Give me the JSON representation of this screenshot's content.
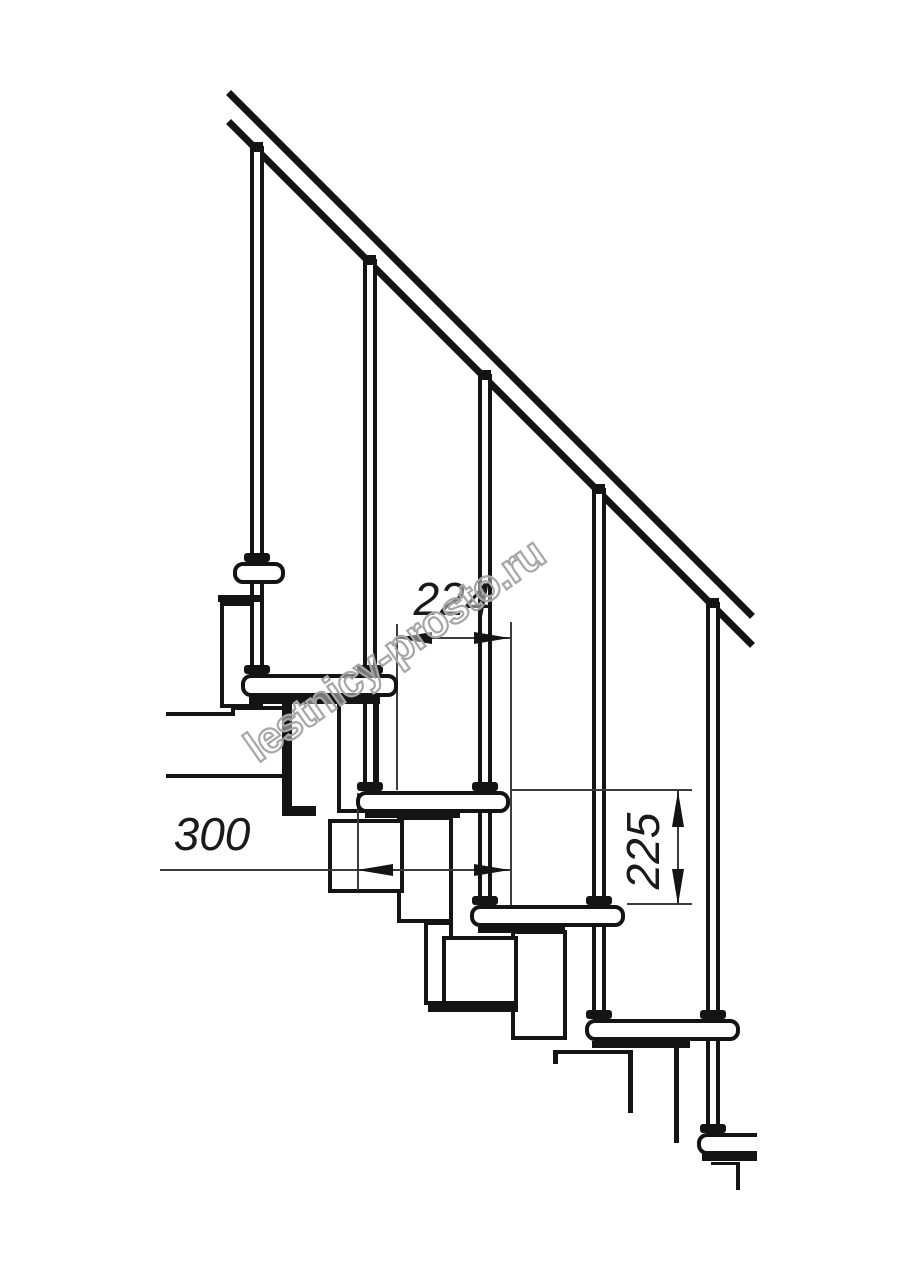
{
  "drawing": {
    "title": "modular-staircase-side-view-technical-drawing",
    "background": "#ffffff",
    "line_color": "#141414",
    "dim_color": "#1a1a1a",
    "watermark_stroke_color": "#a6a6a6",
    "canvas": {
      "width": 914,
      "height": 1280
    }
  },
  "labels": {
    "dim_step_run": "224",
    "dim_tread_depth": "300",
    "dim_step_rise": "225",
    "watermark": "lestnicy-prosto.ru"
  },
  "geometry": {
    "elements": [
      {
        "n": "platform-floor-line-left",
        "c": "line4",
        "x": 166,
        "y": 712,
        "w": 67,
        "h": 4
      },
      {
        "n": "platform-floor-jog",
        "c": "line4",
        "x": 231,
        "y": 706,
        "w": 4,
        "h": 10
      },
      {
        "n": "platform-top-line",
        "c": "line4",
        "x": 233,
        "y": 706,
        "w": 51,
        "h": 4
      },
      {
        "n": "platform-bottom-line",
        "c": "line4",
        "x": 166,
        "y": 774,
        "w": 118,
        "h": 4
      },
      {
        "n": "platform-end-bar",
        "c": "black",
        "x": 282,
        "y": 704,
        "w": 10,
        "h": 112
      },
      {
        "n": "platform-foot-bit",
        "c": "black",
        "x": 282,
        "y": 806,
        "w": 34,
        "h": 10
      },
      {
        "n": "module-v1",
        "c": "module",
        "x": 220,
        "y": 602,
        "w": 43,
        "h": 106
      },
      {
        "n": "module-v2",
        "c": "module",
        "x": 337,
        "y": 700,
        "w": 42,
        "h": 113
      },
      {
        "n": "module-v3",
        "c": "module",
        "x": 397,
        "y": 816,
        "w": 56,
        "h": 107
      },
      {
        "n": "module-v3b",
        "c": "module",
        "x": 424,
        "y": 921,
        "w": 29,
        "h": 84
      },
      {
        "n": "module-v4",
        "c": "module",
        "x": 511,
        "y": 930,
        "w": 56,
        "h": 110
      },
      {
        "n": "module-s2",
        "c": "module",
        "x": 328,
        "y": 819,
        "w": 76,
        "h": 74
      },
      {
        "n": "module-s3",
        "c": "module",
        "x": 442,
        "y": 936,
        "w": 76,
        "h": 69
      },
      {
        "n": "module-s3-flange",
        "c": "black",
        "x": 428,
        "y": 1003,
        "w": 90,
        "h": 9
      },
      {
        "n": "module-s4-top-line",
        "c": "black",
        "x": 553,
        "y": 1050,
        "w": 78,
        "h": 4
      },
      {
        "n": "module-s4-left-stub",
        "c": "black",
        "x": 553,
        "y": 1050,
        "w": 5,
        "h": 14
      },
      {
        "n": "module-v5-left-line",
        "c": "black",
        "x": 628,
        "y": 1050,
        "w": 5,
        "h": 63
      },
      {
        "n": "module-v5-right-line",
        "c": "black",
        "x": 674,
        "y": 1046,
        "w": 5,
        "h": 97
      },
      {
        "n": "base-corner-h-line",
        "c": "black",
        "x": 711,
        "y": 1162,
        "w": 28,
        "h": 3
      },
      {
        "n": "base-corner-v-line",
        "c": "black",
        "x": 736,
        "y": 1162,
        "w": 4,
        "h": 28
      },
      {
        "n": "handrail-top-line",
        "c": "rail",
        "x": 231,
        "y": 90,
        "w": 741,
        "h": 7
      },
      {
        "n": "handrail-bottom-line",
        "c": "rail",
        "x": 231,
        "y": 119,
        "w": 741,
        "h": 7
      },
      {
        "n": "baluster-1",
        "c": "shaft",
        "x": 250,
        "y": 146,
        "w": 14,
        "h": 528
      },
      {
        "n": "baluster-2",
        "c": "shaft",
        "x": 363,
        "y": 259,
        "w": 14,
        "h": 532
      },
      {
        "n": "baluster-3",
        "c": "shaft",
        "x": 478,
        "y": 374,
        "w": 14,
        "h": 531
      },
      {
        "n": "baluster-4",
        "c": "shaft",
        "x": 592,
        "y": 488,
        "w": 14,
        "h": 531
      },
      {
        "n": "baluster-5",
        "c": "shaft",
        "x": 706,
        "y": 602,
        "w": 14,
        "h": 531
      },
      {
        "n": "ext-line-224-left",
        "c": "dline",
        "x": 396,
        "y": 624,
        "w": 2,
        "h": 166
      },
      {
        "n": "ext-line-224-right",
        "c": "dline",
        "x": 510,
        "y": 622,
        "w": 2,
        "h": 285
      },
      {
        "n": "dim-line-224",
        "c": "dline",
        "x": 396,
        "y": 637,
        "w": 114,
        "h": 2
      },
      {
        "n": "dim-leader-300",
        "c": "dline",
        "x": 160,
        "y": 869,
        "w": 350,
        "h": 2
      },
      {
        "n": "ext-line-300-left",
        "c": "dline",
        "x": 357,
        "y": 793,
        "w": 2,
        "h": 97
      },
      {
        "n": "ext-line-225-top",
        "c": "dline",
        "x": 512,
        "y": 789,
        "w": 180,
        "h": 2
      },
      {
        "n": "ext-line-225-bottom",
        "c": "dline",
        "x": 627,
        "y": 903,
        "w": 65,
        "h": 2
      },
      {
        "n": "dim-line-225",
        "c": "dline",
        "x": 677,
        "y": 791,
        "w": 2,
        "h": 114
      },
      {
        "n": "dim-224-arrow-left",
        "c": "arrow-left",
        "x": 396,
        "y": 632,
        "w": 0,
        "h": 0
      },
      {
        "n": "dim-224-arrow-right",
        "c": "arrow-right",
        "x": 474,
        "y": 632,
        "w": 0,
        "h": 0
      },
      {
        "n": "dim-300-arrow-left",
        "c": "arrow-left",
        "x": 357,
        "y": 864,
        "w": 0,
        "h": 0
      },
      {
        "n": "dim-300-arrow-right",
        "c": "arrow-right",
        "x": 474,
        "y": 864,
        "w": 0,
        "h": 0
      },
      {
        "n": "dim-225-arrow-up",
        "c": "arrow-up",
        "x": 672,
        "y": 791,
        "w": 0,
        "h": 0
      },
      {
        "n": "dim-225-arrow-down",
        "c": "arrow-down",
        "x": 672,
        "y": 869,
        "w": 0,
        "h": 0
      },
      {
        "n": "tread-1",
        "c": "tread",
        "x": 233,
        "y": 562,
        "w": 52,
        "h": 22
      },
      {
        "n": "tread-2",
        "c": "tread",
        "x": 241,
        "y": 674,
        "w": 157,
        "h": 23
      },
      {
        "n": "tread-3",
        "c": "tread",
        "x": 356,
        "y": 791,
        "w": 154,
        "h": 22
      },
      {
        "n": "tread-4",
        "c": "tread",
        "x": 470,
        "y": 905,
        "w": 155,
        "h": 22
      },
      {
        "n": "tread-5",
        "c": "tread",
        "x": 585,
        "y": 1019,
        "w": 155,
        "h": 22
      },
      {
        "n": "tread-6",
        "c": "tread tread-cut",
        "x": 697,
        "y": 1133,
        "w": 60,
        "h": 22
      },
      {
        "n": "tread-1-under-bracket",
        "c": "black",
        "x": 218,
        "y": 595,
        "w": 44,
        "h": 7
      },
      {
        "n": "tread-2-under-bracket",
        "c": "black",
        "x": 249,
        "y": 697,
        "w": 131,
        "h": 7
      },
      {
        "n": "tread-3-under-bracket",
        "c": "black",
        "x": 365,
        "y": 812,
        "w": 95,
        "h": 6
      },
      {
        "n": "tread-4-under-bracket",
        "c": "black",
        "x": 478,
        "y": 927,
        "w": 87,
        "h": 6
      },
      {
        "n": "tread-5-under-bracket",
        "c": "black",
        "x": 592,
        "y": 1041,
        "w": 98,
        "h": 7
      },
      {
        "n": "tread-6-under-bracket",
        "c": "black",
        "x": 702,
        "y": 1152,
        "w": 55,
        "h": 9
      },
      {
        "n": "baluster-1-rail-nub",
        "c": "nub",
        "x": 251,
        "y": 142,
        "w": 12,
        "h": 10
      },
      {
        "n": "baluster-2-rail-nub",
        "c": "nub",
        "x": 364,
        "y": 255,
        "w": 12,
        "h": 10
      },
      {
        "n": "baluster-3-rail-nub",
        "c": "nub",
        "x": 479,
        "y": 370,
        "w": 12,
        "h": 10
      },
      {
        "n": "baluster-4-rail-nub",
        "c": "nub",
        "x": 593,
        "y": 484,
        "w": 12,
        "h": 10
      },
      {
        "n": "baluster-5-rail-nub",
        "c": "nub",
        "x": 707,
        "y": 598,
        "w": 12,
        "h": 10
      },
      {
        "n": "baluster-1-collar-upper",
        "c": "collar",
        "x": 244,
        "y": 553,
        "w": 26,
        "h": 9
      },
      {
        "n": "baluster-1-collar-lower",
        "c": "collar",
        "x": 244,
        "y": 665,
        "w": 26,
        "h": 9
      },
      {
        "n": "baluster-2-collar-upper",
        "c": "collar",
        "x": 357,
        "y": 665,
        "w": 26,
        "h": 9
      },
      {
        "n": "baluster-2-collar-lower",
        "c": "collar",
        "x": 357,
        "y": 782,
        "w": 26,
        "h": 9
      },
      {
        "n": "baluster-3-collar-upper",
        "c": "collar",
        "x": 472,
        "y": 782,
        "w": 26,
        "h": 9
      },
      {
        "n": "baluster-3-collar-lower",
        "c": "collar",
        "x": 472,
        "y": 896,
        "w": 26,
        "h": 9
      },
      {
        "n": "baluster-4-collar-upper",
        "c": "collar",
        "x": 586,
        "y": 896,
        "w": 26,
        "h": 9
      },
      {
        "n": "baluster-4-collar-lower",
        "c": "collar",
        "x": 586,
        "y": 1010,
        "w": 26,
        "h": 9
      },
      {
        "n": "baluster-5-collar-upper",
        "c": "collar",
        "x": 700,
        "y": 1010,
        "w": 26,
        "h": 9
      },
      {
        "n": "baluster-5-collar-lower",
        "c": "collar",
        "x": 700,
        "y": 1124,
        "w": 26,
        "h": 9
      },
      {
        "n": "dim-label-224",
        "c": "dimtext",
        "x": 452,
        "y": 599,
        "w": 0,
        "h": 0,
        "t": "dim_step_run"
      },
      {
        "n": "dim-label-300",
        "c": "dimtext",
        "x": 212,
        "y": 834,
        "w": 0,
        "h": 0,
        "t": "dim_tread_depth"
      },
      {
        "n": "dim-label-225",
        "c": "dimtext dimtext-v",
        "x": 643,
        "y": 851,
        "w": 0,
        "h": 0,
        "t": "dim_step_rise"
      },
      {
        "n": "watermark-text",
        "c": "wm",
        "x": 250,
        "y": 730,
        "w": 0,
        "h": 0,
        "t": "watermark"
      }
    ]
  }
}
